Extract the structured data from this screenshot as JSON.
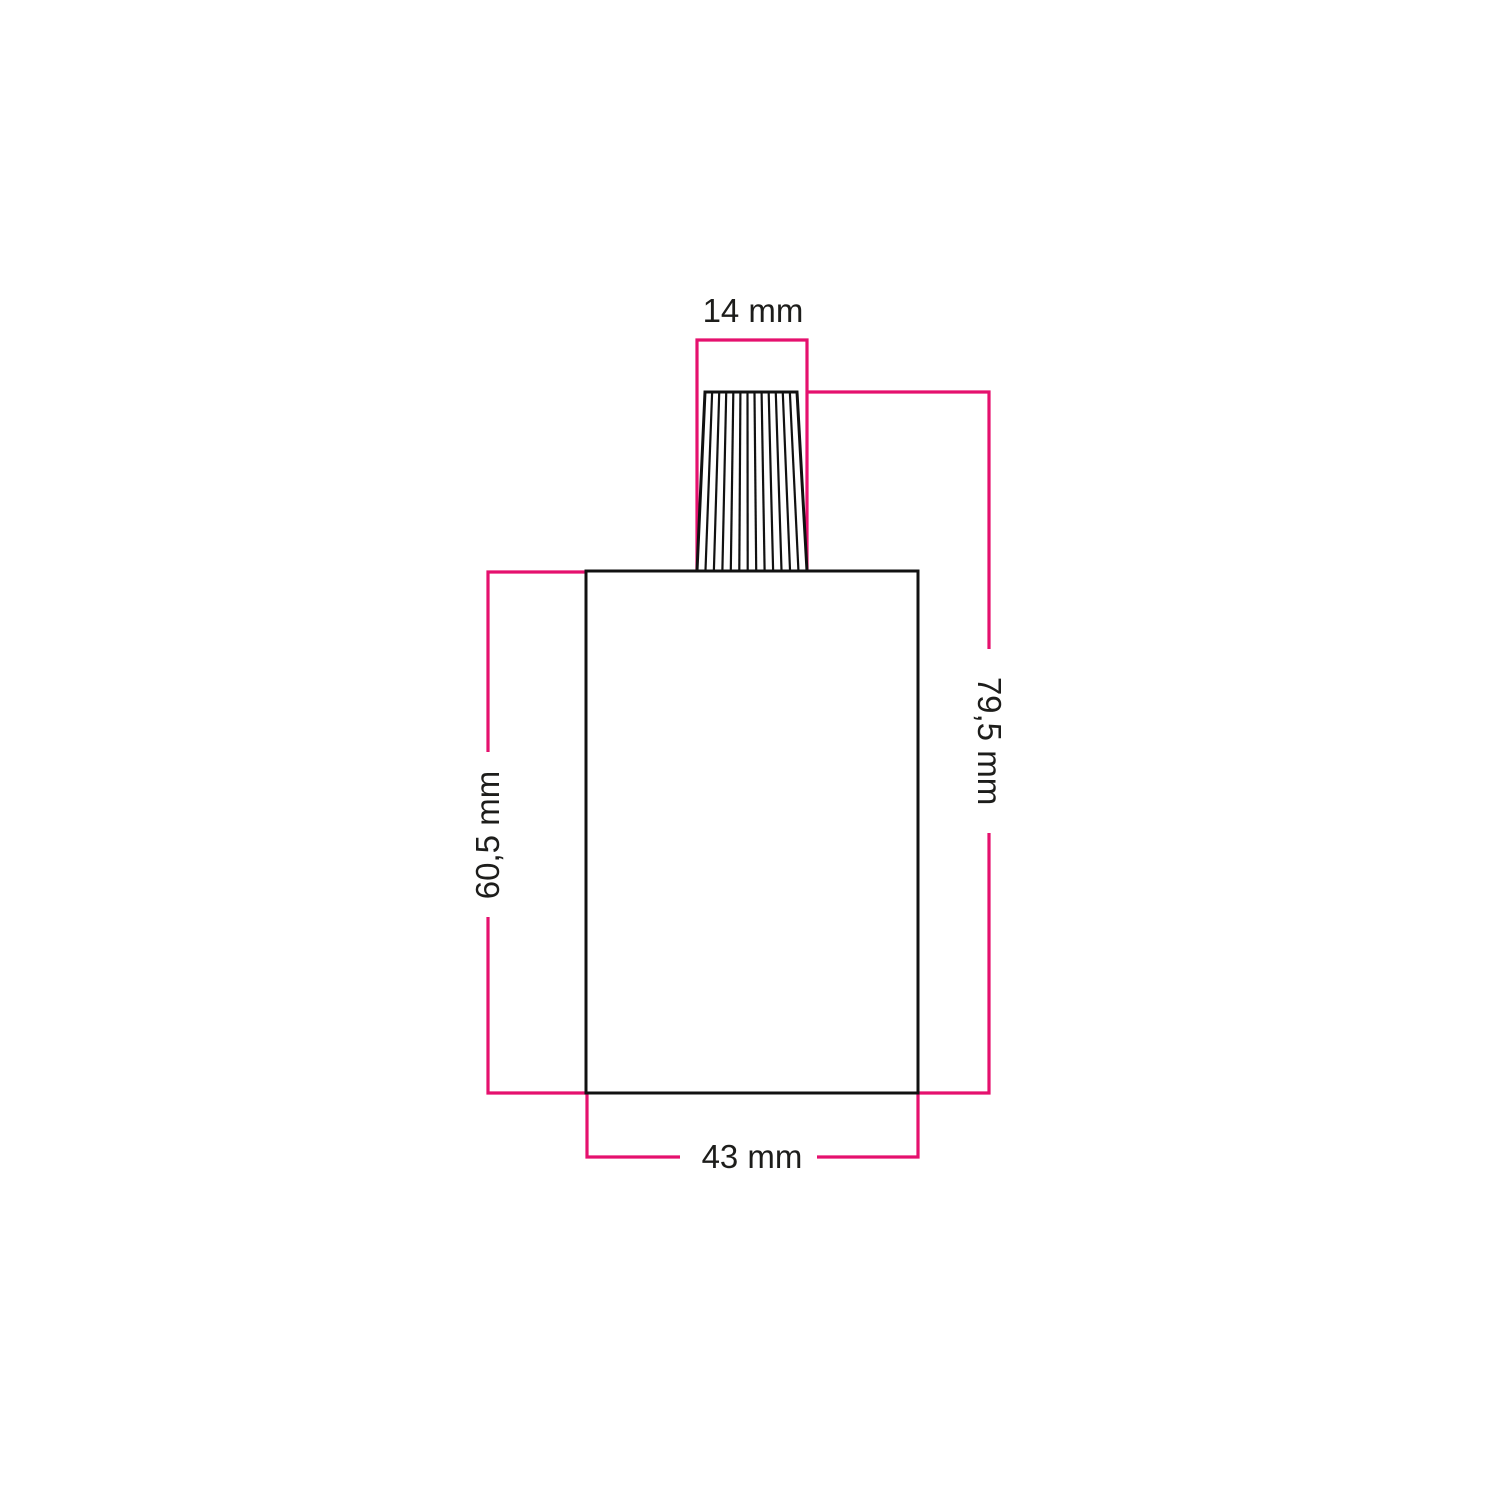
{
  "drawing": {
    "kind": "technical-dimension-drawing",
    "subject": "lamp-holder-with-conical-cable-grip"
  },
  "colors": {
    "accent": "#E5116E",
    "outline": "#111111",
    "label": "#1D1D1B",
    "background": "#FFFFFF"
  },
  "dimensions": {
    "top_width": {
      "label": "14 mm"
    },
    "total_height": {
      "label": "79,5 mm"
    },
    "body_height": {
      "label": "60,5 mm"
    },
    "body_width": {
      "label": "43 mm"
    }
  }
}
